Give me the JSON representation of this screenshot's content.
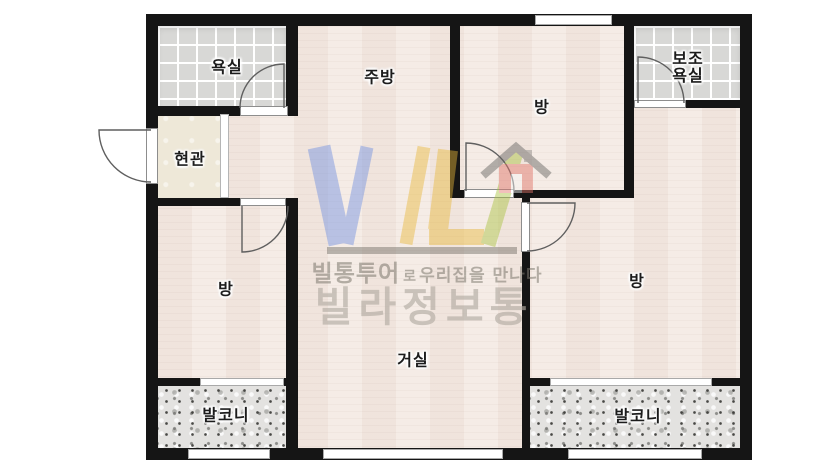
{
  "plan": {
    "type": "apartment-floor-plan",
    "rooms": {
      "bathroom": "욕실",
      "entrance": "현관",
      "kitchen": "주방",
      "room_top": "방",
      "aux_bathroom_line1": "보조",
      "aux_bathroom_line2": "욕실",
      "room_left": "방",
      "living_room": "거실",
      "room_right": "방",
      "balcony_left": "발코니",
      "balcony_right": "발코니"
    }
  },
  "watermark": {
    "logo": "VL",
    "tagline_brand": "빌통투어",
    "tagline_particle": "로",
    "tagline_rest": "우리집을 만나다",
    "brand_name": "빌라정보통"
  },
  "colors": {
    "wall": "#151515",
    "floor": "#f4eae3",
    "entrance_floor": "#eee8d8",
    "tile": "#d8d8d6",
    "balcony": "#e3e2e0",
    "logo_blue": "#6f8fe0",
    "logo_yellow": "#e8b83a",
    "logo_green": "#a8c23e",
    "logo_red": "#e4766b",
    "watermark_gray": "#8a867e"
  }
}
